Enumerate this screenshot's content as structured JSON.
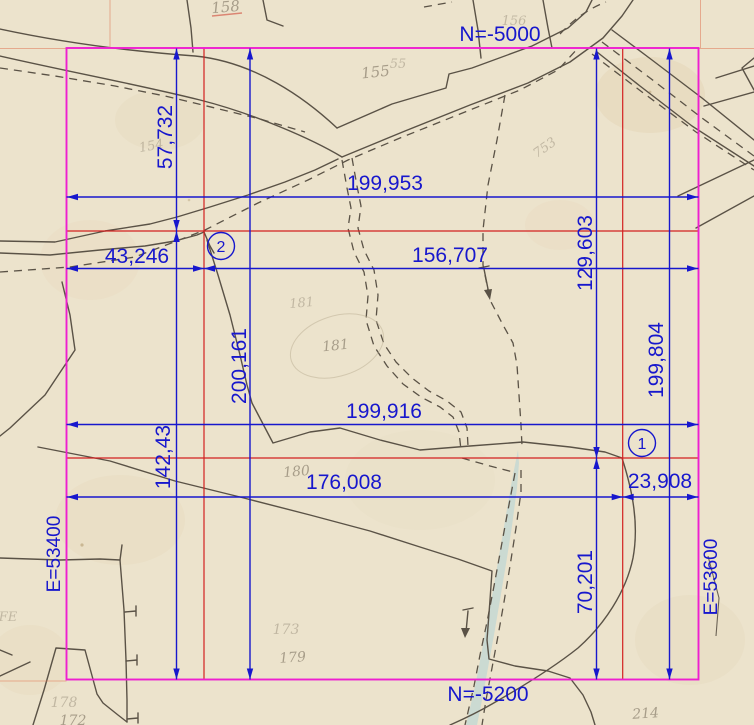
{
  "scene": {
    "description": "Scanned cadastral paper map with geodetic CAD measurement overlay",
    "width_px": 754,
    "height_px": 725
  },
  "colors": {
    "paper": "#ece3cc",
    "map_ink": "#5a5246",
    "overlay_blue": "#1717cd",
    "boundary_magenta": "#ee1fd0",
    "reference_red": "#d32020",
    "stream_fill": "#cbdad2",
    "parcel_label_ink": "#6f6454"
  },
  "grid_labels": {
    "top": "N=-5000",
    "bottom": "N=-5200",
    "left": "E=53400",
    "right": "E=53600"
  },
  "dimensions": {
    "horizontal": [
      {
        "label": "199,953"
      },
      {
        "label": "43,246"
      },
      {
        "label": "156,707"
      },
      {
        "label": "199,916"
      },
      {
        "label": "176,008"
      },
      {
        "label": "23,908"
      }
    ],
    "vertical": [
      {
        "label": "57,732"
      },
      {
        "label": "142,43"
      },
      {
        "label": "200,161"
      },
      {
        "label": "129,603"
      },
      {
        "label": "199,804"
      },
      {
        "label": "70,201"
      }
    ]
  },
  "survey_points": [
    {
      "id": "2"
    },
    {
      "id": "1"
    }
  ],
  "parcel_numbers": [
    {
      "n": "158"
    },
    {
      "n": "156"
    },
    {
      "n": "155"
    },
    {
      "n": "55"
    },
    {
      "n": "154"
    },
    {
      "n": "753"
    },
    {
      "n": "181"
    },
    {
      "n": "181"
    },
    {
      "n": "180"
    },
    {
      "n": "173"
    },
    {
      "n": "179"
    },
    {
      "n": "178"
    },
    {
      "n": "172"
    },
    {
      "n": "214"
    },
    {
      "n": "FE"
    }
  ]
}
